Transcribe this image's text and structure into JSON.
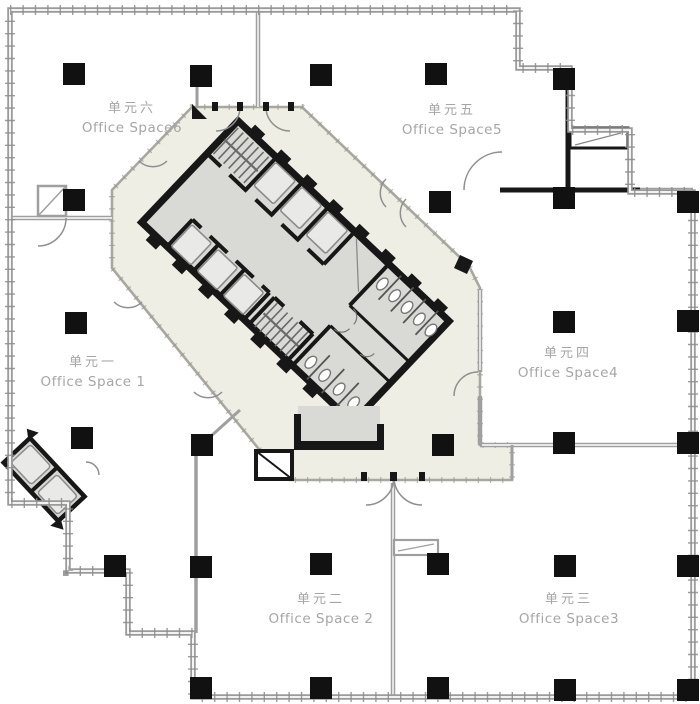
{
  "title": "office-tower-typical-floor-plan",
  "units": [
    {
      "id": "office-space-6",
      "zh": "单元六",
      "en": "Office Space6",
      "cx": 132,
      "cy": 110
    },
    {
      "id": "office-space-5",
      "zh": "单元五",
      "en": "Office Space5",
      "cx": 452,
      "cy": 112
    },
    {
      "id": "office-space-1",
      "zh": "单元一",
      "en": "Office Space 1",
      "cx": 93,
      "cy": 364
    },
    {
      "id": "office-space-4",
      "zh": "单元四",
      "en": "Office Space4",
      "cx": 568,
      "cy": 355
    },
    {
      "id": "office-space-2",
      "zh": "单元二",
      "en": "Office Space 2",
      "cx": 321,
      "cy": 601
    },
    {
      "id": "office-space-3",
      "zh": "单元三",
      "en": "Office Space3",
      "cx": 569,
      "cy": 601
    }
  ],
  "plan": {
    "columns": [
      [
        74,
        74
      ],
      [
        201,
        76
      ],
      [
        321,
        75
      ],
      [
        436,
        74
      ],
      [
        564,
        79
      ],
      [
        74,
        200
      ],
      [
        440,
        202
      ],
      [
        564,
        198
      ],
      [
        688,
        202
      ],
      [
        76,
        323
      ],
      [
        564,
        322
      ],
      [
        688,
        321
      ],
      [
        82,
        438
      ],
      [
        202,
        445
      ],
      [
        443,
        445
      ],
      [
        564,
        443
      ],
      [
        688,
        443
      ],
      [
        115,
        566
      ],
      [
        201,
        567
      ],
      [
        321,
        564
      ],
      [
        438,
        564
      ],
      [
        565,
        566
      ],
      [
        688,
        566
      ],
      [
        201,
        688
      ],
      [
        321,
        688
      ],
      [
        438,
        688
      ],
      [
        565,
        690
      ],
      [
        688,
        690
      ]
    ],
    "icons": [
      "column",
      "door-arc",
      "stair-treads",
      "elevator-car",
      "toilet-fixture",
      "shaft-box"
    ]
  },
  "colors": {
    "background": "#ffffff",
    "outer_wall": "#9b9b9b",
    "partition": "#9f9f9f",
    "core_wall": "#171717",
    "core_floor": "#d9d9d6",
    "corridor_fill": "#efeee5",
    "corridor_edge": "#a8a7a0",
    "column": "#111111",
    "label_text": "#a6a6a6"
  }
}
